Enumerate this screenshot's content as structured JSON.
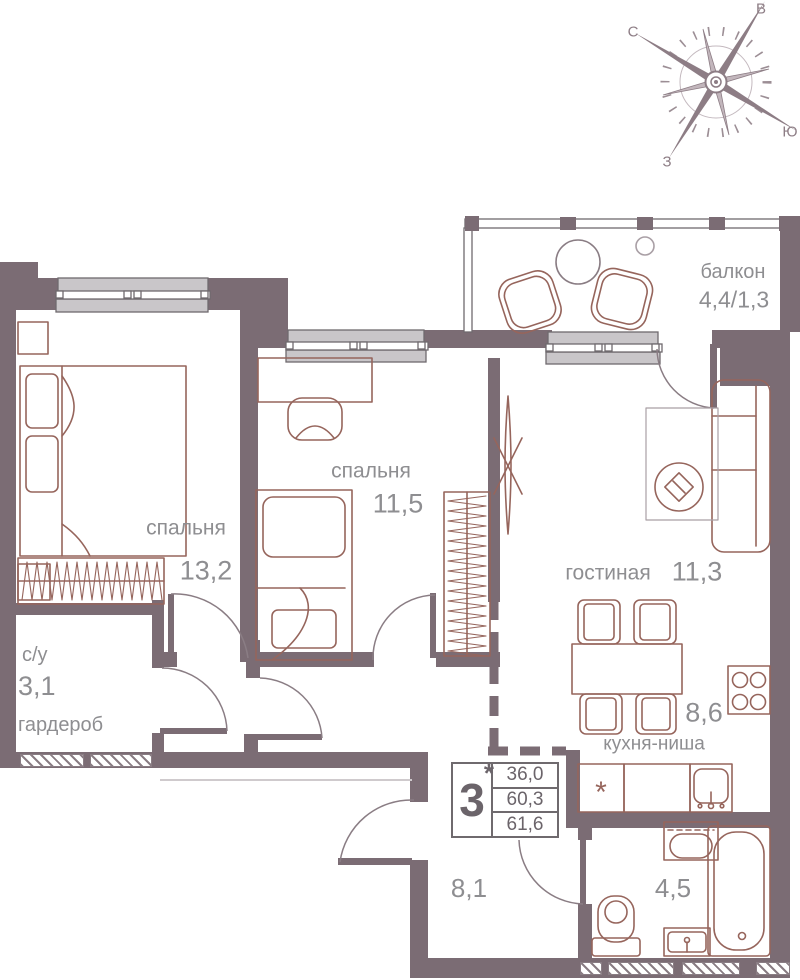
{
  "rooms": {
    "bedroom1": {
      "name": "спальня",
      "area": "13,2"
    },
    "bedroom2": {
      "name": "спальня",
      "area": "11,5"
    },
    "living": {
      "name": "гостиная",
      "area": "11,3"
    },
    "kitchen": {
      "name": "кухня-ниша",
      "area": "8,6",
      "fridge_symbol": "*"
    },
    "su": {
      "name": "с/у",
      "area": "3,1"
    },
    "wardrobe": {
      "name": "гардероб"
    },
    "hall": {
      "area": "8,1"
    },
    "bathroom": {
      "area": "4,5"
    },
    "balcony": {
      "name": "балкон",
      "area": "4,4/1,3"
    }
  },
  "stamp": {
    "rooms_count": "3",
    "asterisk": "*",
    "values": [
      "36,0",
      "60,3",
      "61,6"
    ]
  },
  "compass": {
    "north": "С",
    "east": "В",
    "south": "Ю",
    "west": "З"
  },
  "colors": {
    "wall": "#7b6c74",
    "furniture_outline": "#96655c",
    "label_text": "#8e8e91",
    "window_sill": "#c9c6c9",
    "stamp_text": "#6b646a",
    "compass": "#8d7d85"
  }
}
